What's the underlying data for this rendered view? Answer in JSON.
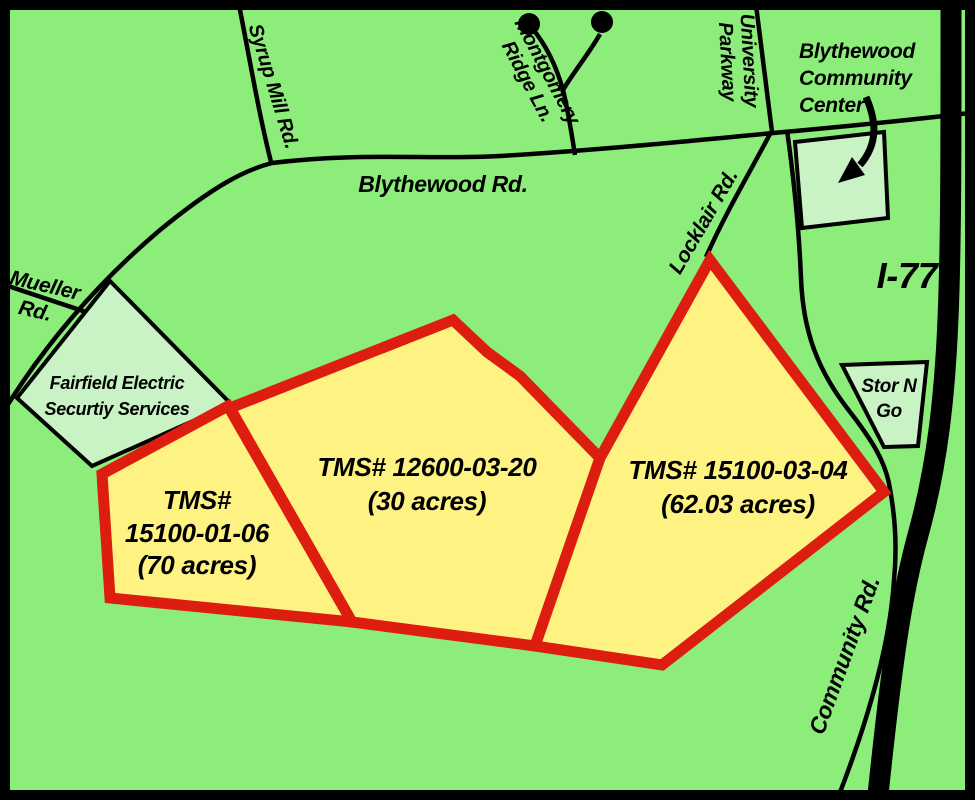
{
  "colors": {
    "background": "#8DED7B",
    "parcel_fill": "#FEF382",
    "parcel_stroke": "#DC1D10",
    "landmark_fill": "#C9F3C4",
    "road_color": "#000000"
  },
  "parcels": [
    {
      "id": "15100-01-06",
      "lines": [
        "TMS#",
        "15100-01-06",
        "(70 acres)"
      ]
    },
    {
      "id": "12600-03-20",
      "lines": [
        "TMS# 12600-03-20",
        "(30 acres)"
      ]
    },
    {
      "id": "15100-03-04",
      "lines": [
        "TMS# 15100-03-04",
        "(62.03 acres)"
      ]
    }
  ],
  "roads": {
    "blythewood": "Blythewood Rd.",
    "syrup_mill": "Syrup Mill Rd.",
    "mueller": [
      "Mueller",
      "Rd."
    ],
    "montgomery": [
      "Montgomery",
      "Ridge Ln."
    ],
    "university": [
      "University",
      "Parkway"
    ],
    "locklair": "Locklair Rd.",
    "community_rd": "Community Rd.",
    "i77": "I-77"
  },
  "landmarks": {
    "community_center": [
      "Blythewood",
      "Community",
      "Center"
    ],
    "stor_n_go": [
      "Stor N",
      "Go"
    ],
    "fairfield": [
      "Fairfield Electric",
      "Securtiy Services"
    ]
  }
}
